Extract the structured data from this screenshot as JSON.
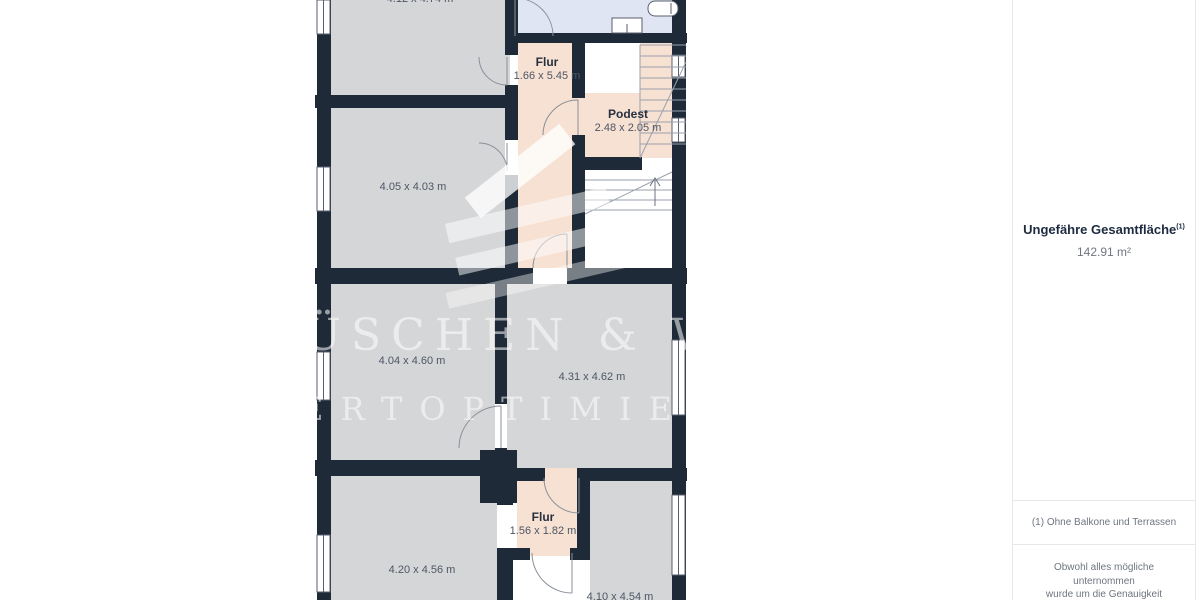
{
  "floorplan": {
    "colors": {
      "wall": "#1f2a38",
      "room_fill": "#d5d6d8",
      "hallway_fill": "#f7e1d3",
      "bathroom_fill": "#dfe5f2"
    },
    "watermark": {
      "line1": "ÜSCHEN & W",
      "line2": "ERTOPTIMIER"
    },
    "rooms": {
      "top_left": {
        "dims": "4.12 x 4.74 m"
      },
      "flur_upper": {
        "name": "Flur",
        "dims": "1.66 x 5.45 m"
      },
      "podest": {
        "name": "Podest",
        "dims": "2.48 x 2.05 m"
      },
      "left_mid": {
        "dims": "4.05 x 4.03 m"
      },
      "center_left": {
        "dims": "4.04 x 4.60 m"
      },
      "center_right": {
        "dims": "4.31 x 4.62 m"
      },
      "flur_lower": {
        "name": "Flur",
        "dims": "1.56 x 1.82 m"
      },
      "bottom_left": {
        "dims": "4.20 x 4.56 m"
      },
      "bottom_right": {
        "dims": "4.10 x 4.54 m"
      }
    }
  },
  "sidebar": {
    "total_area": {
      "label": "Ungefähre Gesamtfläche",
      "marker": "(1)",
      "value": "142.91 m²"
    },
    "footnote": "(1) Ohne Balkone und Terrassen",
    "disclaimer_lines": [
      "Obwohl alles mögliche unternommen",
      "wurde um die Genauigkeit",
      "sicherzustellen, sind alle Messungen"
    ]
  }
}
